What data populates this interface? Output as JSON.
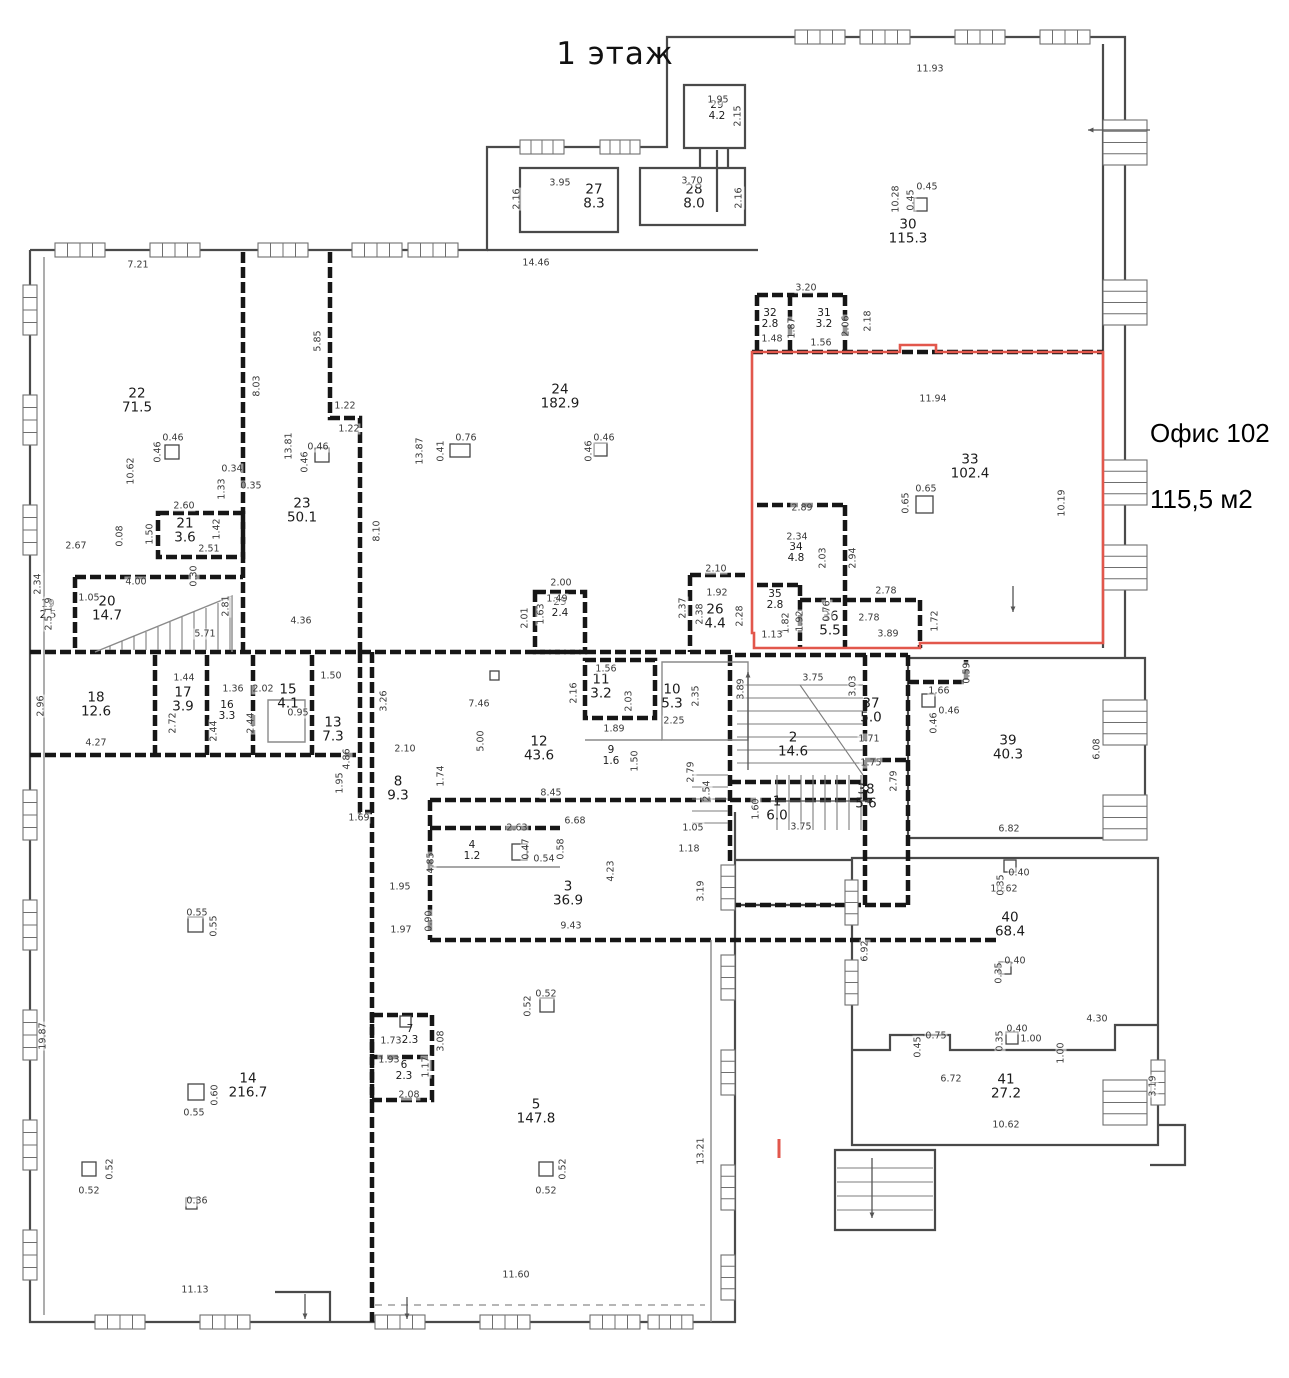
{
  "floor_title": "1 этаж",
  "callout": {
    "title": "Офис 102",
    "area": "115,5 м2"
  },
  "colors": {
    "wall": "#4a4a4a",
    "partition": "#161616",
    "thin": "#8a8a8a",
    "accent_red": "#e2574c"
  },
  "rooms": [
    {
      "n": "1",
      "a": "6.0",
      "x": 777,
      "y": 810
    },
    {
      "n": "2",
      "a": "14.6",
      "x": 793,
      "y": 746
    },
    {
      "n": "3",
      "a": "36.9",
      "x": 568,
      "y": 895
    },
    {
      "n": "4",
      "a": "1.2",
      "x": 472,
      "y": 852,
      "s": 1
    },
    {
      "n": "5",
      "a": "147.8",
      "x": 536,
      "y": 1113
    },
    {
      "n": "6",
      "a": "2.3",
      "x": 404,
      "y": 1072,
      "s": 1
    },
    {
      "n": "7",
      "a": "2.3",
      "x": 410,
      "y": 1036,
      "s": 1
    },
    {
      "n": "8",
      "a": "9.3",
      "x": 398,
      "y": 790
    },
    {
      "n": "9",
      "a": "1.6",
      "x": 611,
      "y": 757,
      "s": 1
    },
    {
      "n": "10",
      "a": "5.3",
      "x": 672,
      "y": 698
    },
    {
      "n": "11",
      "a": "3.2",
      "x": 601,
      "y": 688
    },
    {
      "n": "12",
      "a": "43.6",
      "x": 539,
      "y": 750
    },
    {
      "n": "13",
      "a": "7.3",
      "x": 333,
      "y": 731
    },
    {
      "n": "14",
      "a": "216.7",
      "x": 248,
      "y": 1087
    },
    {
      "n": "15",
      "a": "4.1",
      "x": 288,
      "y": 698
    },
    {
      "n": "16",
      "a": "3.3",
      "x": 227,
      "y": 712,
      "s": 1
    },
    {
      "n": "17",
      "a": "3.9",
      "x": 183,
      "y": 701
    },
    {
      "n": "18",
      "a": "12.6",
      "x": 96,
      "y": 706
    },
    {
      "n": "19",
      "a": "2.5",
      "x": 48,
      "y": 611,
      "s": 1
    },
    {
      "n": "20",
      "a": "14.7",
      "x": 107,
      "y": 610
    },
    {
      "n": "21",
      "a": "3.6",
      "x": 185,
      "y": 532
    },
    {
      "n": "22",
      "a": "71.5",
      "x": 137,
      "y": 402
    },
    {
      "n": "23",
      "a": "50.1",
      "x": 302,
      "y": 512
    },
    {
      "n": "24",
      "a": "182.9",
      "x": 560,
      "y": 398
    },
    {
      "n": "25",
      "a": "2.4",
      "x": 560,
      "y": 609,
      "s": 1
    },
    {
      "n": "26",
      "a": "4.4",
      "x": 715,
      "y": 618
    },
    {
      "n": "27",
      "a": "8.3",
      "x": 594,
      "y": 198
    },
    {
      "n": "28",
      "a": "8.0",
      "x": 694,
      "y": 198
    },
    {
      "n": "29",
      "a": "4.2",
      "x": 717,
      "y": 112,
      "s": 1
    },
    {
      "n": "30",
      "a": "115.3",
      "x": 908,
      "y": 233
    },
    {
      "n": "31",
      "a": "3.2",
      "x": 824,
      "y": 320,
      "s": 1
    },
    {
      "n": "32",
      "a": "2.8",
      "x": 770,
      "y": 320,
      "s": 1
    },
    {
      "n": "33",
      "a": "102.4",
      "x": 970,
      "y": 468
    },
    {
      "n": "34",
      "a": "4.8",
      "x": 796,
      "y": 554,
      "s": 1
    },
    {
      "n": "35",
      "a": "2.8",
      "x": 775,
      "y": 601,
      "s": 1
    },
    {
      "n": "36",
      "a": "5.5",
      "x": 830,
      "y": 625
    },
    {
      "n": "37",
      "a": "5.0",
      "x": 871,
      "y": 712
    },
    {
      "n": "38",
      "a": "5.6",
      "x": 866,
      "y": 798
    },
    {
      "n": "39",
      "a": "40.3",
      "x": 1008,
      "y": 749
    },
    {
      "n": "40",
      "a": "68.4",
      "x": 1010,
      "y": 926
    },
    {
      "n": "41",
      "a": "27.2",
      "x": 1006,
      "y": 1088
    }
  ],
  "dims": [
    {
      "t": "1.95",
      "x": 718,
      "y": 100
    },
    {
      "t": "2.15",
      "x": 738,
      "y": 116,
      "v": 1
    },
    {
      "t": "3.95",
      "x": 560,
      "y": 183
    },
    {
      "t": "2.16",
      "x": 517,
      "y": 199,
      "v": 1
    },
    {
      "t": "3.70",
      "x": 692,
      "y": 181
    },
    {
      "t": "2.16",
      "x": 739,
      "y": 198,
      "v": 1
    },
    {
      "t": "14.46",
      "x": 536,
      "y": 263
    },
    {
      "t": "7.21",
      "x": 138,
      "y": 265
    },
    {
      "t": "11.93",
      "x": 930,
      "y": 69
    },
    {
      "t": "10.28",
      "x": 896,
      "y": 199,
      "v": 1
    },
    {
      "t": "0.45",
      "x": 927,
      "y": 187
    },
    {
      "t": "0.45",
      "x": 911,
      "y": 200,
      "v": 1
    },
    {
      "t": "3.20",
      "x": 806,
      "y": 288
    },
    {
      "t": "2.18",
      "x": 868,
      "y": 321,
      "v": 1
    },
    {
      "t": "1.87",
      "x": 792,
      "y": 328,
      "v": 1
    },
    {
      "t": "1.48",
      "x": 772,
      "y": 339
    },
    {
      "t": "1.56",
      "x": 821,
      "y": 343
    },
    {
      "t": "2.06",
      "x": 846,
      "y": 326,
      "v": 1
    },
    {
      "t": "11.94",
      "x": 933,
      "y": 399
    },
    {
      "t": "10.19",
      "x": 1062,
      "y": 503,
      "v": 1
    },
    {
      "t": "0.65",
      "x": 926,
      "y": 489
    },
    {
      "t": "0.65",
      "x": 906,
      "y": 503,
      "v": 1
    },
    {
      "t": "2.89",
      "x": 802,
      "y": 508
    },
    {
      "t": "2.34",
      "x": 797,
      "y": 537
    },
    {
      "t": "2.03",
      "x": 823,
      "y": 558,
      "v": 1
    },
    {
      "t": "2.94",
      "x": 853,
      "y": 558,
      "v": 1
    },
    {
      "t": "2.10",
      "x": 716,
      "y": 569
    },
    {
      "t": "1.92",
      "x": 717,
      "y": 593
    },
    {
      "t": "2.78",
      "x": 886,
      "y": 591
    },
    {
      "t": "2.37",
      "x": 683,
      "y": 608,
      "v": 1
    },
    {
      "t": "2.28",
      "x": 740,
      "y": 616,
      "v": 1
    },
    {
      "t": "2.38",
      "x": 700,
      "y": 614,
      "v": 1
    },
    {
      "t": "2.78",
      "x": 869,
      "y": 618
    },
    {
      "t": "3.89",
      "x": 888,
      "y": 634
    },
    {
      "t": "1.72",
      "x": 935,
      "y": 621,
      "v": 1
    },
    {
      "t": "1.92",
      "x": 800,
      "y": 621,
      "v": 1
    },
    {
      "t": "1.82",
      "x": 786,
      "y": 623,
      "v": 1
    },
    {
      "t": "1.13",
      "x": 772,
      "y": 635
    },
    {
      "t": "0.76",
      "x": 827,
      "y": 611,
      "v": 1
    },
    {
      "t": "8.03",
      "x": 257,
      "y": 386,
      "v": 1
    },
    {
      "t": "5.85",
      "x": 318,
      "y": 341,
      "v": 1
    },
    {
      "t": "13.81",
      "x": 289,
      "y": 446,
      "v": 1
    },
    {
      "t": "13.87",
      "x": 420,
      "y": 451,
      "v": 1
    },
    {
      "t": "10.62",
      "x": 131,
      "y": 471,
      "v": 1
    },
    {
      "t": "0.46",
      "x": 173,
      "y": 438
    },
    {
      "t": "0.46",
      "x": 158,
      "y": 452,
      "v": 1
    },
    {
      "t": "0.46",
      "x": 318,
      "y": 447
    },
    {
      "t": "0.46",
      "x": 305,
      "y": 462,
      "v": 1
    },
    {
      "t": "0.76",
      "x": 466,
      "y": 438
    },
    {
      "t": "0.41",
      "x": 441,
      "y": 451,
      "v": 1
    },
    {
      "t": "0.46",
      "x": 604,
      "y": 438
    },
    {
      "t": "0.46",
      "x": 589,
      "y": 451,
      "v": 1
    },
    {
      "t": "1.22",
      "x": 345,
      "y": 406
    },
    {
      "t": "1.22",
      "x": 349,
      "y": 429
    },
    {
      "t": "0.34",
      "x": 232,
      "y": 469
    },
    {
      "t": "0.35",
      "x": 251,
      "y": 486
    },
    {
      "t": "1.33",
      "x": 222,
      "y": 489,
      "v": 1
    },
    {
      "t": "2.60",
      "x": 184,
      "y": 506
    },
    {
      "t": "1.50",
      "x": 150,
      "y": 534,
      "v": 1
    },
    {
      "t": "1.42",
      "x": 217,
      "y": 529,
      "v": 1
    },
    {
      "t": "2.51",
      "x": 209,
      "y": 549
    },
    {
      "t": "0.08",
      "x": 120,
      "y": 536,
      "v": 1
    },
    {
      "t": "2.67",
      "x": 76,
      "y": 546
    },
    {
      "t": "0.30",
      "x": 194,
      "y": 576,
      "v": 1
    },
    {
      "t": "4.00",
      "x": 136,
      "y": 582
    },
    {
      "t": "2.81",
      "x": 226,
      "y": 606,
      "v": 1
    },
    {
      "t": "5.71",
      "x": 205,
      "y": 634
    },
    {
      "t": "4.36",
      "x": 301,
      "y": 621
    },
    {
      "t": "8.10",
      "x": 377,
      "y": 531,
      "v": 1
    },
    {
      "t": "2.34",
      "x": 38,
      "y": 584,
      "v": 1
    },
    {
      "t": "1.9",
      "x": 49,
      "y": 605,
      "v": 1
    },
    {
      "t": "2.5",
      "x": 49,
      "y": 623,
      "v": 1
    },
    {
      "t": "1.05",
      "x": 89,
      "y": 598
    },
    {
      "t": "2.00",
      "x": 561,
      "y": 583
    },
    {
      "t": "1.49",
      "x": 557,
      "y": 599
    },
    {
      "t": "2.01",
      "x": 525,
      "y": 618,
      "v": 1
    },
    {
      "t": "1.63",
      "x": 541,
      "y": 614,
      "v": 1
    },
    {
      "t": "1.44",
      "x": 184,
      "y": 678
    },
    {
      "t": "2.96",
      "x": 41,
      "y": 706,
      "v": 1
    },
    {
      "t": "1.36",
      "x": 233,
      "y": 689
    },
    {
      "t": "2.02",
      "x": 263,
      "y": 689
    },
    {
      "t": "1.50",
      "x": 331,
      "y": 676
    },
    {
      "t": "4.27",
      "x": 96,
      "y": 743
    },
    {
      "t": "2.72",
      "x": 173,
      "y": 723,
      "v": 1
    },
    {
      "t": "2.44",
      "x": 214,
      "y": 731,
      "v": 1
    },
    {
      "t": "2.44",
      "x": 251,
      "y": 723,
      "v": 1
    },
    {
      "t": "0.95",
      "x": 298,
      "y": 713
    },
    {
      "t": "3.26",
      "x": 384,
      "y": 701,
      "v": 1
    },
    {
      "t": "7.46",
      "x": 479,
      "y": 704
    },
    {
      "t": "5.00",
      "x": 481,
      "y": 741,
      "v": 1
    },
    {
      "t": "2.16",
      "x": 574,
      "y": 693,
      "v": 1
    },
    {
      "t": "1.56",
      "x": 606,
      "y": 669
    },
    {
      "t": "2.03",
      "x": 629,
      "y": 701,
      "v": 1
    },
    {
      "t": "2.35",
      "x": 696,
      "y": 696,
      "v": 1
    },
    {
      "t": "2.25",
      "x": 674,
      "y": 721
    },
    {
      "t": "1.89",
      "x": 614,
      "y": 729
    },
    {
      "t": "1.50",
      "x": 635,
      "y": 761,
      "v": 1
    },
    {
      "t": "3.89",
      "x": 741,
      "y": 689,
      "v": 1
    },
    {
      "t": "3.75",
      "x": 813,
      "y": 678
    },
    {
      "t": "3.03",
      "x": 853,
      "y": 686,
      "v": 1
    },
    {
      "t": "1.66",
      "x": 939,
      "y": 691
    },
    {
      "t": "0.59",
      "x": 967,
      "y": 673,
      "v": 1
    },
    {
      "t": "0.46",
      "x": 949,
      "y": 711
    },
    {
      "t": "0.46",
      "x": 934,
      "y": 723,
      "v": 1
    },
    {
      "t": "1.71",
      "x": 869,
      "y": 739
    },
    {
      "t": "1.75",
      "x": 871,
      "y": 763
    },
    {
      "t": "2.79",
      "x": 894,
      "y": 781,
      "v": 1
    },
    {
      "t": "6.08",
      "x": 1097,
      "y": 749,
      "v": 1
    },
    {
      "t": "1.74",
      "x": 441,
      "y": 776,
      "v": 1
    },
    {
      "t": "2.10",
      "x": 405,
      "y": 749
    },
    {
      "t": "8.45",
      "x": 551,
      "y": 793
    },
    {
      "t": "1.60",
      "x": 756,
      "y": 809,
      "v": 1
    },
    {
      "t": "3.75",
      "x": 801,
      "y": 827
    },
    {
      "t": "2.54",
      "x": 707,
      "y": 791,
      "v": 1
    },
    {
      "t": "2.79",
      "x": 691,
      "y": 772,
      "v": 1
    },
    {
      "t": "1.05",
      "x": 693,
      "y": 828
    },
    {
      "t": "1.18",
      "x": 689,
      "y": 849
    },
    {
      "t": "6.68",
      "x": 575,
      "y": 821
    },
    {
      "t": "2.63",
      "x": 517,
      "y": 828
    },
    {
      "t": "0.54",
      "x": 544,
      "y": 859
    },
    {
      "t": "0.47",
      "x": 526,
      "y": 849,
      "v": 1
    },
    {
      "t": "0.58",
      "x": 561,
      "y": 849,
      "v": 1
    },
    {
      "t": "1.69",
      "x": 359,
      "y": 818
    },
    {
      "t": "1.95",
      "x": 340,
      "y": 783,
      "v": 1
    },
    {
      "t": "4.86",
      "x": 347,
      "y": 759,
      "v": 1
    },
    {
      "t": "1.95",
      "x": 400,
      "y": 887
    },
    {
      "t": "4.85",
      "x": 431,
      "y": 863,
      "v": 1
    },
    {
      "t": "1.97",
      "x": 401,
      "y": 930
    },
    {
      "t": "0.90",
      "x": 429,
      "y": 921,
      "v": 1
    },
    {
      "t": "9.43",
      "x": 571,
      "y": 926
    },
    {
      "t": "4.23",
      "x": 611,
      "y": 871,
      "v": 1
    },
    {
      "t": "3.19",
      "x": 701,
      "y": 891,
      "v": 1
    },
    {
      "t": "6.92",
      "x": 865,
      "y": 951,
      "v": 1
    },
    {
      "t": "10.62",
      "x": 1004,
      "y": 889
    },
    {
      "t": "0.40",
      "x": 1019,
      "y": 873
    },
    {
      "t": "0.35",
      "x": 1001,
      "y": 885,
      "v": 1
    },
    {
      "t": "0.40",
      "x": 1015,
      "y": 961
    },
    {
      "t": "0.35",
      "x": 999,
      "y": 973,
      "v": 1
    },
    {
      "t": "6.82",
      "x": 1009,
      "y": 829
    },
    {
      "t": "4.30",
      "x": 1097,
      "y": 1019
    },
    {
      "t": "0.75",
      "x": 936,
      "y": 1036
    },
    {
      "t": "0.45",
      "x": 918,
      "y": 1047,
      "v": 1
    },
    {
      "t": "0.40",
      "x": 1017,
      "y": 1029
    },
    {
      "t": "0.35",
      "x": 1000,
      "y": 1041,
      "v": 1
    },
    {
      "t": "1.00",
      "x": 1031,
      "y": 1039
    },
    {
      "t": "1.00",
      "x": 1061,
      "y": 1053,
      "v": 1
    },
    {
      "t": "6.72",
      "x": 951,
      "y": 1079
    },
    {
      "t": "10.62",
      "x": 1006,
      "y": 1125
    },
    {
      "t": "3.19",
      "x": 1153,
      "y": 1086,
      "v": 1
    },
    {
      "t": "13.21",
      "x": 701,
      "y": 1151,
      "v": 1
    },
    {
      "t": "11.60",
      "x": 516,
      "y": 1275
    },
    {
      "t": "11.13",
      "x": 195,
      "y": 1290
    },
    {
      "t": "19.87",
      "x": 43,
      "y": 1036,
      "v": 1
    },
    {
      "t": "0.55",
      "x": 197,
      "y": 913
    },
    {
      "t": "0.55",
      "x": 214,
      "y": 926,
      "v": 1
    },
    {
      "t": "0.60",
      "x": 215,
      "y": 1095,
      "v": 1
    },
    {
      "t": "0.55",
      "x": 194,
      "y": 1113
    },
    {
      "t": "0.36",
      "x": 197,
      "y": 1201
    },
    {
      "t": "0.52",
      "x": 546,
      "y": 994
    },
    {
      "t": "0.52",
      "x": 528,
      "y": 1006,
      "v": 1
    },
    {
      "t": "0.52",
      "x": 110,
      "y": 1169,
      "v": 1
    },
    {
      "t": "0.52",
      "x": 89,
      "y": 1191
    },
    {
      "t": "0.52",
      "x": 563,
      "y": 1169,
      "v": 1
    },
    {
      "t": "0.52",
      "x": 546,
      "y": 1191
    },
    {
      "t": "1.73",
      "x": 391,
      "y": 1041
    },
    {
      "t": "3.08",
      "x": 441,
      "y": 1041,
      "v": 1
    },
    {
      "t": "1.93",
      "x": 389,
      "y": 1060
    },
    {
      "t": "1.17",
      "x": 426,
      "y": 1067,
      "v": 1
    },
    {
      "t": "2.08",
      "x": 409,
      "y": 1095
    }
  ]
}
